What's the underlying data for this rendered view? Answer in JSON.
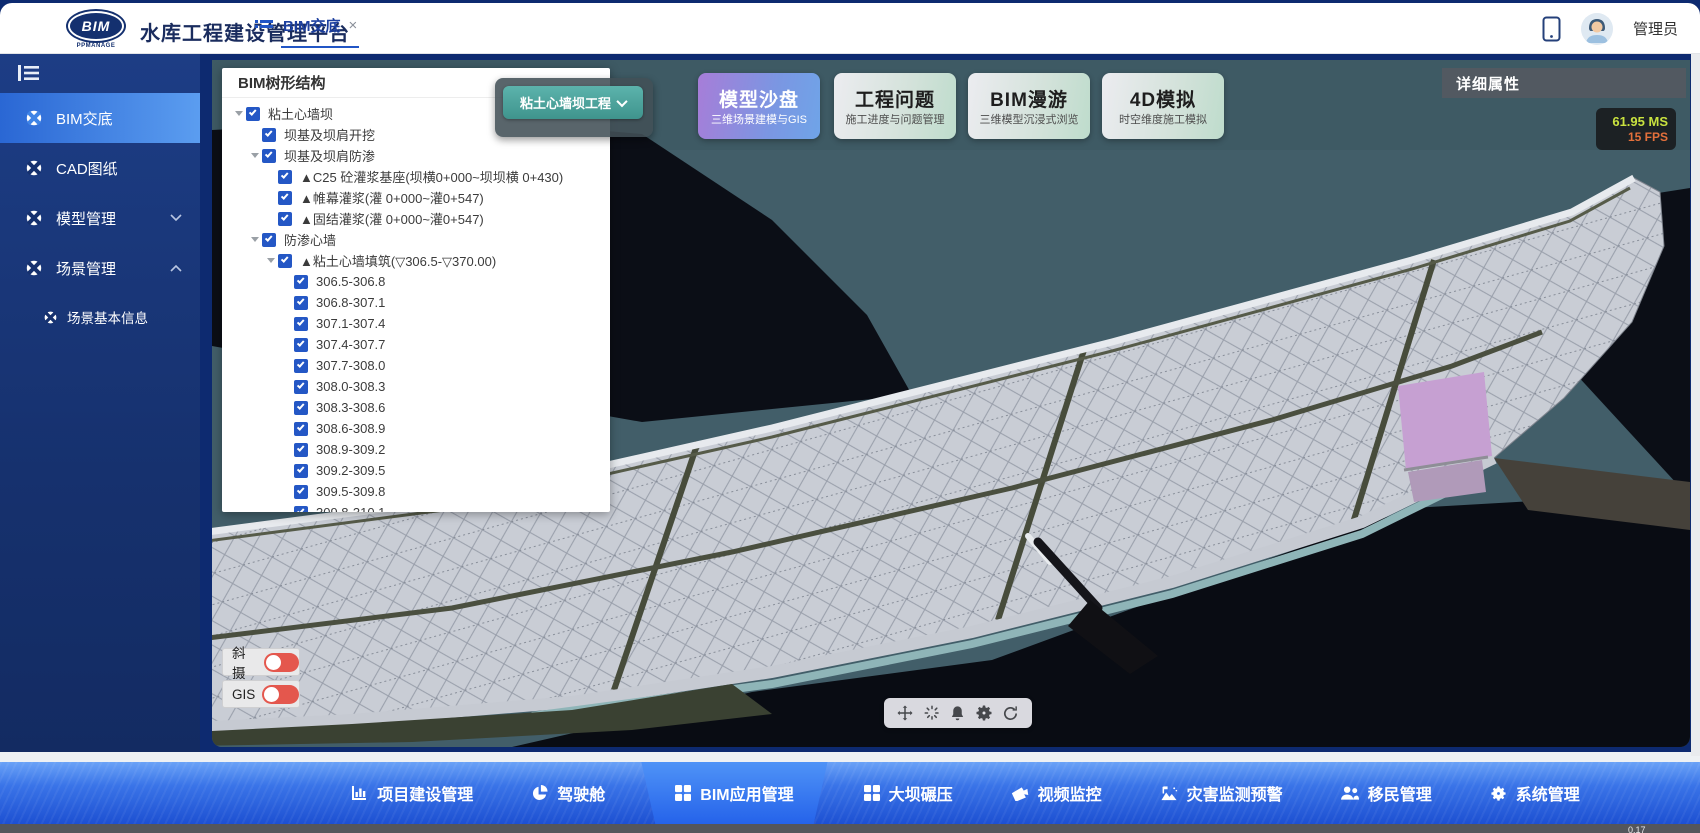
{
  "header": {
    "logo_text": "BIM",
    "logo_sub": "PPMANAGE",
    "title": "水库工程建设管理平台",
    "tab": "BIM交底",
    "tab_close": "×",
    "user": "管理员"
  },
  "sidebar": {
    "items": [
      {
        "label": "BIM交底"
      },
      {
        "label": "CAD图纸"
      },
      {
        "label": "模型管理"
      },
      {
        "label": "场景管理"
      },
      {
        "label": "场景基本信息"
      }
    ]
  },
  "tree": {
    "panel_title": "BIM树形结构",
    "project_selector": "粘土心墙坝工程",
    "rows": [
      {
        "label": "粘土心墙坝"
      },
      {
        "label": "坝基及坝肩开挖"
      },
      {
        "label": "坝基及坝肩防渗"
      },
      {
        "label": "▲C25 砼灌浆基座(坝横0+000~坝坝横 0+430)"
      },
      {
        "label": "▲帷幕灌浆(灌 0+000~灌0+547)"
      },
      {
        "label": "▲固结灌浆(灌 0+000~灌0+547)"
      },
      {
        "label": "防渗心墙"
      },
      {
        "label": "▲粘土心墙填筑(▽306.5-▽370.00)"
      },
      {
        "label": "306.5-306.8"
      },
      {
        "label": "306.8-307.1"
      },
      {
        "label": "307.1-307.4"
      },
      {
        "label": "307.4-307.7"
      },
      {
        "label": "307.7-308.0"
      },
      {
        "label": "308.0-308.3"
      },
      {
        "label": "308.3-308.6"
      },
      {
        "label": "308.6-308.9"
      },
      {
        "label": "308.9-309.2"
      },
      {
        "label": "309.2-309.5"
      },
      {
        "label": "309.5-309.8"
      },
      {
        "label": "309.8-310.1"
      }
    ]
  },
  "cards": [
    {
      "title": "模型沙盘",
      "subtitle": "三维场景建模与GIS"
    },
    {
      "title": "工程问题",
      "subtitle": "施工进度与问题管理"
    },
    {
      "title": "BIM漫游",
      "subtitle": "三维模型沉浸式浏览"
    },
    {
      "title": "4D模拟",
      "subtitle": "时空维度施工模拟"
    }
  ],
  "right_panel": {
    "title": "详细属性"
  },
  "stats": {
    "ms": "61.95 MS",
    "fps": "15 FPS",
    "corner": "0.17"
  },
  "toggles": [
    {
      "label": "斜摄"
    },
    {
      "label": "GIS"
    }
  ],
  "bottom_nav": {
    "items": [
      {
        "label": "项目建设管理"
      },
      {
        "label": "驾驶舱"
      },
      {
        "label": "BIM应用管理"
      },
      {
        "label": "大坝碾压"
      },
      {
        "label": "视频监控"
      },
      {
        "label": "灾害监测预警"
      },
      {
        "label": "移民管理"
      },
      {
        "label": "系统管理"
      }
    ]
  },
  "colors": {
    "accent_blue": "#2155c5",
    "sidebar_navy": "#16316e",
    "active_item": "#5b9df0",
    "viewport_teal": "#415d68",
    "selected_card": "#a77dd8",
    "selector_teal": "#3f948d",
    "toggle_red": "#e4574d",
    "ms_yellow": "#c9e23f",
    "fps_orange": "#e4703b"
  }
}
